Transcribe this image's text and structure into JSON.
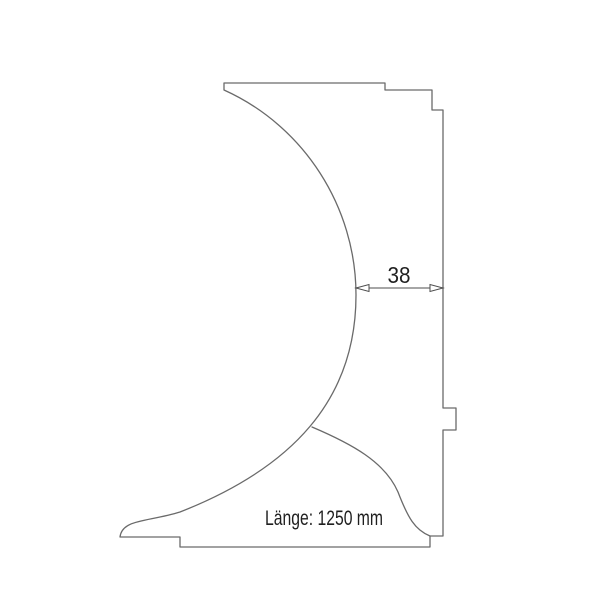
{
  "drawing": {
    "kind": "profile-cross-section-technical-drawing",
    "background_color": "#ffffff",
    "line_color": "#6a6a6a",
    "dimension_line_color": "#4d4d4d",
    "text_color": "#1f1f1f",
    "profile": {
      "outline_path": "M 224 83 L 385 83 L 385 90 L 432 90 L 432 110 L 443 110 L 443 408 L 456 408 L 456 430 L 443 430 L 443 536 L 430 536 L 430 547 L 180 547 L 180 537 L 120 537 C 122 519 148 522 180 512 C 292 468 356 400 356 295 C 356 207 304 126 224 90 Z",
      "inner_curve_path": "M 312 427 C 352 444 385 462 398 492 C 408 518 415 530 430 536",
      "arrowhead_left_points": "356,288 369,284.5 369,291.5",
      "arrowhead_right_points": "443,288 430,284.5 430,291.5"
    },
    "dimension": {
      "value": "38"
    },
    "length_note": "Länge: 1250 mm"
  }
}
